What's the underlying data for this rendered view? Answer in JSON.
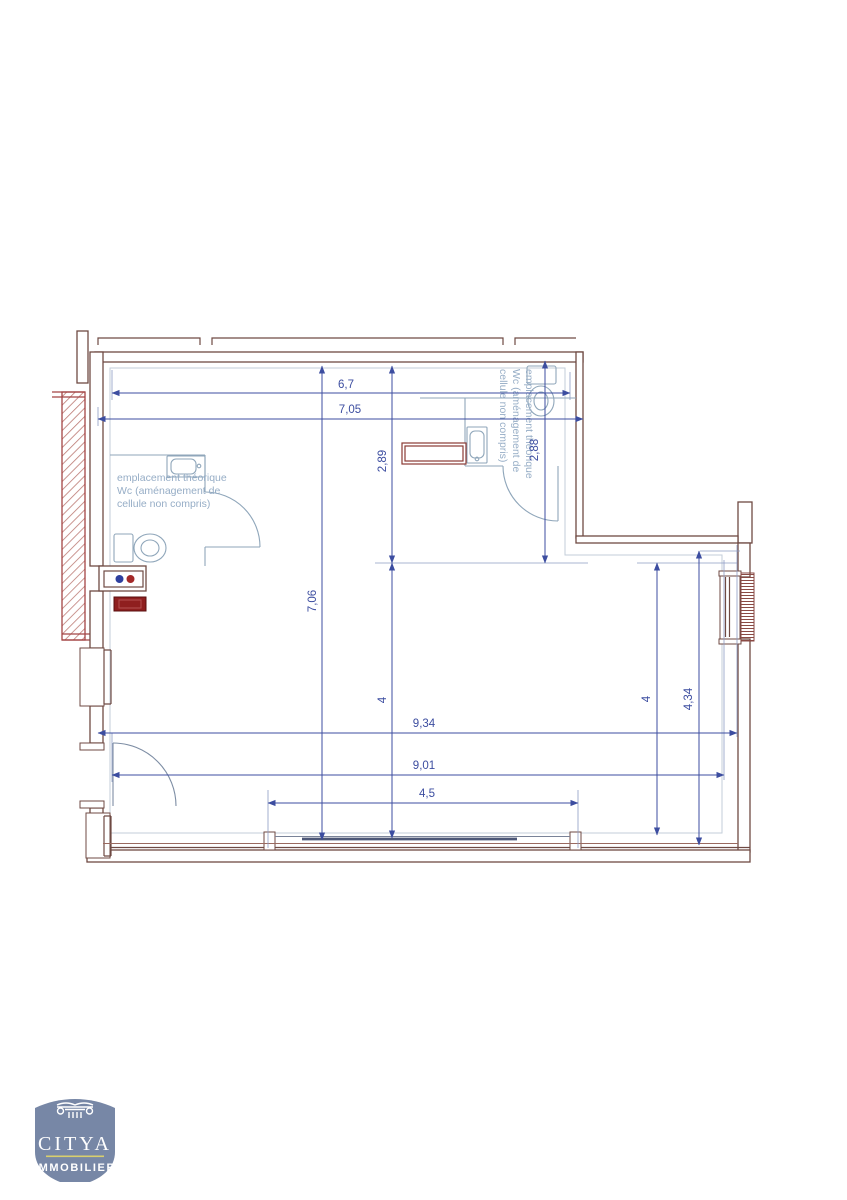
{
  "plan": {
    "wc_note": {
      "line1": "emplacement théorique",
      "line2": "Wc (aménagement de",
      "line3": "cellule non compris)"
    },
    "dimensions": {
      "top_width_inner": "6,7",
      "top_width_outer": "7,05",
      "wc_left_height": "2,89",
      "wc_right_height": "2,88",
      "left_total_height": "7,06",
      "mid_left_height": "4",
      "mid_right_height": "4",
      "right_lower_height": "4,34",
      "bottom_width_outer": "9,34",
      "bottom_width_inner": "9,01",
      "storefront_width": "4,5"
    }
  },
  "icons": {
    "toilet-icon": "plan toilet symbol (tank + bowl ellipse)",
    "sink-icon": "plan hand-basin symbol",
    "door-swing-icon": "quarter-circle door swing",
    "window-icon": "double-line glazing in wall",
    "radiator-icon": "hatched block on right wall",
    "water-meter-icon": "box with blue and red supply dots",
    "column-capital-icon": "ionic column capital in logo"
  },
  "colors": {
    "wall": "#6f4a43",
    "wall2": "#a34545",
    "dim": "#3c4da0",
    "witness": "#8d9cc4",
    "fixture": "#8fa6ba",
    "note": "#96adc6",
    "inset": "#c3ced9",
    "duct": "#8a3a34",
    "redFill": "#8f1f1f",
    "blueDot": "#2e3f9e",
    "redDot": "#a32828",
    "logoBg": "#7787a6",
    "logoGold": "#d8cf6d"
  },
  "logo": {
    "brand": "CITYA",
    "subtitle": "IMMOBILIER"
  }
}
